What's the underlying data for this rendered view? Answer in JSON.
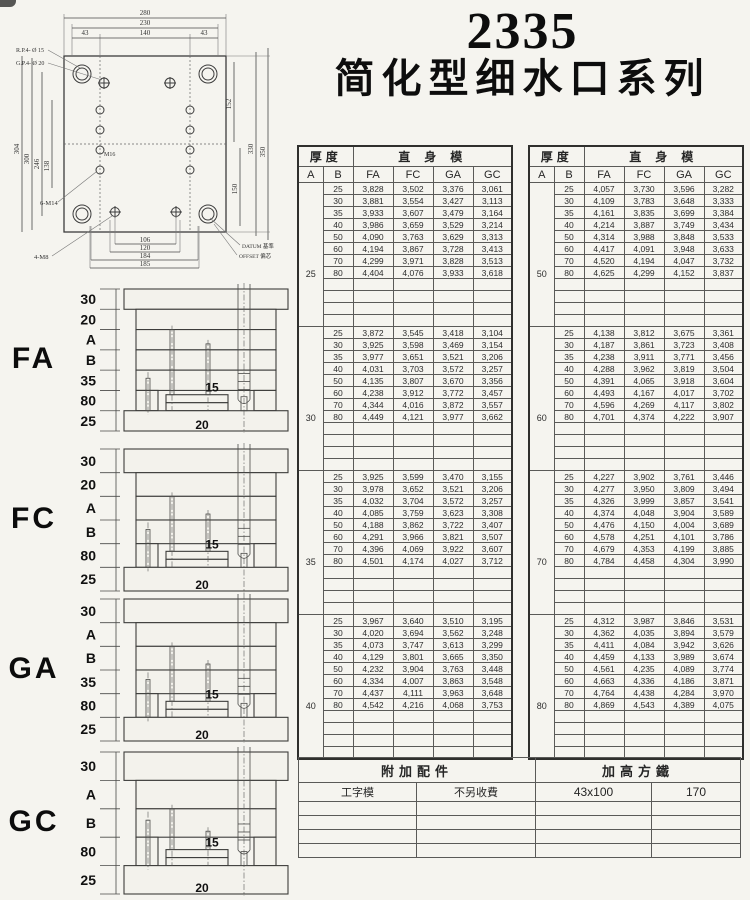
{
  "title": {
    "model": "2335",
    "series": "简化型细水口系列"
  },
  "drawing": {
    "top_dims": [
      "280",
      "230",
      "43",
      "140",
      "43"
    ],
    "pin_labels": [
      "R.P.4- Ø 15",
      "G.P.4- Ø 20"
    ],
    "left_dims": [
      "304",
      "300",
      "246",
      "138"
    ],
    "center_label": "M16",
    "right_dims": [
      "152",
      "150",
      "330",
      "350"
    ],
    "bottom_dims": [
      "106",
      "120",
      "184",
      "185"
    ],
    "thread_labels": [
      "6-M14",
      "4-M8"
    ],
    "notes": [
      "DATUM 基準",
      "OFFSET 偏芯"
    ]
  },
  "price_tables": {
    "header": {
      "thickness": "厚度",
      "straight": "直身模",
      "a": "A",
      "b": "B",
      "cols": [
        "FA",
        "FC",
        "GA",
        "GC"
      ]
    },
    "b_values": [
      "25",
      "30",
      "35",
      "40",
      "50",
      "60",
      "70",
      "80"
    ],
    "left_groups": [
      {
        "a": "25",
        "rows": [
          {
            "b": "25",
            "v": [
              "3,828",
              "3,502",
              "3,376",
              "3,061"
            ]
          },
          {
            "b": "30",
            "v": [
              "3,881",
              "3,554",
              "3,427",
              "3,113"
            ]
          },
          {
            "b": "35",
            "v": [
              "3,933",
              "3,607",
              "3,479",
              "3,164"
            ]
          },
          {
            "b": "40",
            "v": [
              "3,986",
              "3,659",
              "3,529",
              "3,214"
            ]
          },
          {
            "b": "50",
            "v": [
              "4,090",
              "3,763",
              "3,629",
              "3,313"
            ]
          },
          {
            "b": "60",
            "v": [
              "4,194",
              "3,867",
              "3,728",
              "3,413"
            ]
          },
          {
            "b": "70",
            "v": [
              "4,299",
              "3,971",
              "3,828",
              "3,513"
            ]
          },
          {
            "b": "80",
            "v": [
              "4,404",
              "4,076",
              "3,933",
              "3,618"
            ]
          }
        ]
      },
      {
        "a": "30",
        "rows": [
          {
            "b": "25",
            "v": [
              "3,872",
              "3,545",
              "3,418",
              "3,104"
            ]
          },
          {
            "b": "30",
            "v": [
              "3,925",
              "3,598",
              "3,469",
              "3,154"
            ]
          },
          {
            "b": "35",
            "v": [
              "3,977",
              "3,651",
              "3,521",
              "3,206"
            ]
          },
          {
            "b": "40",
            "v": [
              "4,031",
              "3,703",
              "3,572",
              "3,257"
            ]
          },
          {
            "b": "50",
            "v": [
              "4,135",
              "3,807",
              "3,670",
              "3,356"
            ]
          },
          {
            "b": "60",
            "v": [
              "4,238",
              "3,912",
              "3,772",
              "3,457"
            ]
          },
          {
            "b": "70",
            "v": [
              "4,344",
              "4,016",
              "3,872",
              "3,557"
            ]
          },
          {
            "b": "80",
            "v": [
              "4,449",
              "4,121",
              "3,977",
              "3,662"
            ]
          }
        ]
      },
      {
        "a": "35",
        "rows": [
          {
            "b": "25",
            "v": [
              "3,925",
              "3,599",
              "3,470",
              "3,155"
            ]
          },
          {
            "b": "30",
            "v": [
              "3,978",
              "3,652",
              "3,521",
              "3,206"
            ]
          },
          {
            "b": "35",
            "v": [
              "4,032",
              "3,704",
              "3,572",
              "3,257"
            ]
          },
          {
            "b": "40",
            "v": [
              "4,085",
              "3,759",
              "3,623",
              "3,308"
            ]
          },
          {
            "b": "50",
            "v": [
              "4,188",
              "3,862",
              "3,722",
              "3,407"
            ]
          },
          {
            "b": "60",
            "v": [
              "4,291",
              "3,966",
              "3,821",
              "3,507"
            ]
          },
          {
            "b": "70",
            "v": [
              "4,396",
              "4,069",
              "3,922",
              "3,607"
            ]
          },
          {
            "b": "80",
            "v": [
              "4,501",
              "4,174",
              "4,027",
              "3,712"
            ]
          }
        ]
      },
      {
        "a": "40",
        "rows": [
          {
            "b": "25",
            "v": [
              "3,967",
              "3,640",
              "3,510",
              "3,195"
            ]
          },
          {
            "b": "30",
            "v": [
              "4,020",
              "3,694",
              "3,562",
              "3,248"
            ]
          },
          {
            "b": "35",
            "v": [
              "4,073",
              "3,747",
              "3,613",
              "3,299"
            ]
          },
          {
            "b": "40",
            "v": [
              "4,129",
              "3,801",
              "3,665",
              "3,350"
            ]
          },
          {
            "b": "50",
            "v": [
              "4,232",
              "3,904",
              "3,763",
              "3,448"
            ]
          },
          {
            "b": "60",
            "v": [
              "4,334",
              "4,007",
              "3,863",
              "3,548"
            ]
          },
          {
            "b": "70",
            "v": [
              "4,437",
              "4,111",
              "3,963",
              "3,648"
            ]
          },
          {
            "b": "80",
            "v": [
              "4,542",
              "4,216",
              "4,068",
              "3,753"
            ]
          }
        ]
      }
    ],
    "right_groups": [
      {
        "a": "50",
        "rows": [
          {
            "b": "25",
            "v": [
              "4,057",
              "3,730",
              "3,596",
              "3,282"
            ]
          },
          {
            "b": "30",
            "v": [
              "4,109",
              "3,783",
              "3,648",
              "3,333"
            ]
          },
          {
            "b": "35",
            "v": [
              "4,161",
              "3,835",
              "3,699",
              "3,384"
            ]
          },
          {
            "b": "40",
            "v": [
              "4,214",
              "3,887",
              "3,749",
              "3,434"
            ]
          },
          {
            "b": "50",
            "v": [
              "4,314",
              "3,988",
              "3,848",
              "3,533"
            ]
          },
          {
            "b": "60",
            "v": [
              "4,417",
              "4,091",
              "3,948",
              "3,633"
            ]
          },
          {
            "b": "70",
            "v": [
              "4,520",
              "4,194",
              "4,047",
              "3,732"
            ]
          },
          {
            "b": "80",
            "v": [
              "4,625",
              "4,299",
              "4,152",
              "3,837"
            ]
          }
        ]
      },
      {
        "a": "60",
        "rows": [
          {
            "b": "25",
            "v": [
              "4,138",
              "3,812",
              "3,675",
              "3,361"
            ]
          },
          {
            "b": "30",
            "v": [
              "4,187",
              "3,861",
              "3,723",
              "3,408"
            ]
          },
          {
            "b": "35",
            "v": [
              "4,238",
              "3,911",
              "3,771",
              "3,456"
            ]
          },
          {
            "b": "40",
            "v": [
              "4,288",
              "3,962",
              "3,819",
              "3,504"
            ]
          },
          {
            "b": "50",
            "v": [
              "4,391",
              "4,065",
              "3,918",
              "3,604"
            ]
          },
          {
            "b": "60",
            "v": [
              "4,493",
              "4,167",
              "4,017",
              "3,702"
            ]
          },
          {
            "b": "70",
            "v": [
              "4,596",
              "4,269",
              "4,117",
              "3,802"
            ]
          },
          {
            "b": "80",
            "v": [
              "4,701",
              "4,374",
              "4,222",
              "3,907"
            ]
          }
        ]
      },
      {
        "a": "70",
        "rows": [
          {
            "b": "25",
            "v": [
              "4,227",
              "3,902",
              "3,761",
              "3,446"
            ]
          },
          {
            "b": "30",
            "v": [
              "4,277",
              "3,950",
              "3,809",
              "3,494"
            ]
          },
          {
            "b": "35",
            "v": [
              "4,326",
              "3,999",
              "3,857",
              "3,541"
            ]
          },
          {
            "b": "40",
            "v": [
              "4,374",
              "4,048",
              "3,904",
              "3,589"
            ]
          },
          {
            "b": "50",
            "v": [
              "4,476",
              "4,150",
              "4,004",
              "3,689"
            ]
          },
          {
            "b": "60",
            "v": [
              "4,578",
              "4,251",
              "4,101",
              "3,786"
            ]
          },
          {
            "b": "70",
            "v": [
              "4,679",
              "4,353",
              "4,199",
              "3,885"
            ]
          },
          {
            "b": "80",
            "v": [
              "4,784",
              "4,458",
              "4,304",
              "3,990"
            ]
          }
        ]
      },
      {
        "a": "80",
        "rows": [
          {
            "b": "25",
            "v": [
              "4,312",
              "3,987",
              "3,846",
              "3,531"
            ]
          },
          {
            "b": "30",
            "v": [
              "4,362",
              "4,035",
              "3,894",
              "3,579"
            ]
          },
          {
            "b": "35",
            "v": [
              "4,411",
              "4,084",
              "3,942",
              "3,626"
            ]
          },
          {
            "b": "40",
            "v": [
              "4,459",
              "4,133",
              "3,989",
              "3,674"
            ]
          },
          {
            "b": "50",
            "v": [
              "4,561",
              "4,235",
              "4,089",
              "3,774"
            ]
          },
          {
            "b": "60",
            "v": [
              "4,663",
              "4,336",
              "4,186",
              "3,871"
            ]
          },
          {
            "b": "70",
            "v": [
              "4,764",
              "4,438",
              "4,284",
              "3,970"
            ]
          },
          {
            "b": "80",
            "v": [
              "4,869",
              "4,543",
              "4,389",
              "4,075"
            ]
          }
        ]
      }
    ]
  },
  "diagrams": [
    {
      "type": "FA",
      "stack_labels": [
        "30",
        "20",
        "A",
        "B",
        "35",
        "80",
        "25"
      ],
      "inner_labels": [
        "15",
        "20"
      ]
    },
    {
      "type": "FC",
      "stack_labels": [
        "30",
        "20",
        "A",
        "B",
        "80",
        "25"
      ],
      "inner_labels": [
        "15",
        "20"
      ]
    },
    {
      "type": "GA",
      "stack_labels": [
        "30",
        "A",
        "B",
        "35",
        "80",
        "25"
      ],
      "inner_labels": [
        "15",
        "20"
      ]
    },
    {
      "type": "GC",
      "stack_labels": [
        "30",
        "A",
        "B",
        "80",
        "25"
      ],
      "inner_labels": [
        "15",
        "20"
      ]
    }
  ],
  "addon_table": {
    "header_left": "附加配件",
    "header_right": "加高方鐵",
    "row": [
      "工字模",
      "不另收費",
      "43x100",
      "170"
    ],
    "empty_row_count": 4
  }
}
